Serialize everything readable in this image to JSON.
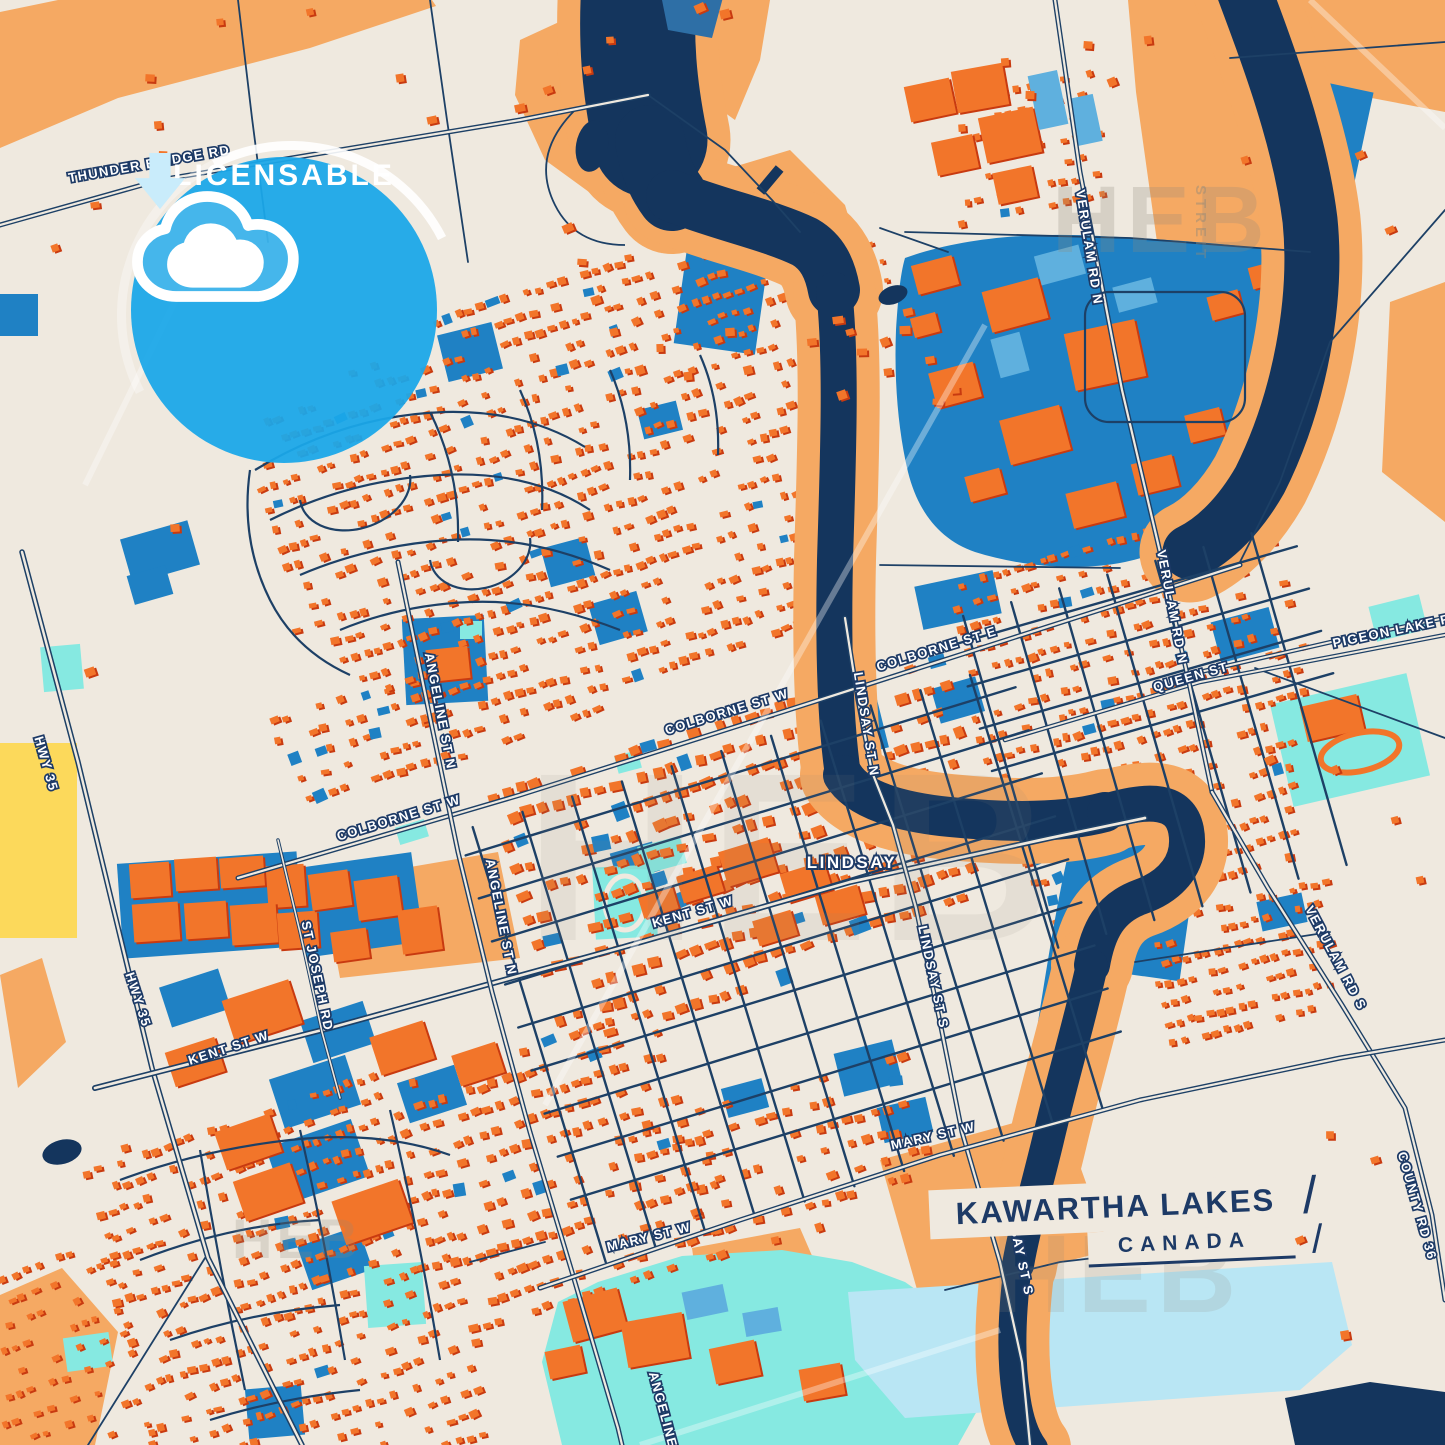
{
  "poster": {
    "region_label": "LINDSAY",
    "title": "KAWARTHA LAKES",
    "subtitle": "CANADA",
    "separator": "/",
    "badge": {
      "label": "LICENSABLE",
      "icon": "cloud-download-icon"
    },
    "watermark": {
      "brand": "HEB",
      "sub": "STREIT"
    },
    "street_labels": [
      {
        "id": "thunder",
        "text": "THUNDER BRIDGE RD"
      },
      {
        "id": "verulam-n-1",
        "text": "VERULAM RD N"
      },
      {
        "id": "verulam-n-2",
        "text": "VERULAM RD N"
      },
      {
        "id": "pigeon",
        "text": "PIGEON LAKE RD"
      },
      {
        "id": "queen",
        "text": "QUEEN ST"
      },
      {
        "id": "colborne-e",
        "text": "COLBORNE ST E"
      },
      {
        "id": "colborne-w-1",
        "text": "COLBORNE ST W"
      },
      {
        "id": "colborne-w-2",
        "text": "COLBORNE ST W"
      },
      {
        "id": "lindsay-n",
        "text": "LINDSAY ST N"
      },
      {
        "id": "kent-w-1",
        "text": "KENT ST W"
      },
      {
        "id": "kent-w-2",
        "text": "KENT ST W"
      },
      {
        "id": "lindsay-s-1",
        "text": "LINDSAY ST S"
      },
      {
        "id": "lindsay-s-2",
        "text": "LINDSAY ST S"
      },
      {
        "id": "angeline-n-1",
        "text": "ANGELINE ST N"
      },
      {
        "id": "angeline-n-2",
        "text": "ANGELINE ST N"
      },
      {
        "id": "angeline-s",
        "text": "ANGELINE ST S"
      },
      {
        "id": "st-joseph",
        "text": "ST JOSEPH RD"
      },
      {
        "id": "mary-w-1",
        "text": "MARY ST W"
      },
      {
        "id": "mary-w-2",
        "text": "MARY ST W"
      },
      {
        "id": "hwy35-1",
        "text": "HWY 35"
      },
      {
        "id": "hwy35-2",
        "text": "HWY 35"
      },
      {
        "id": "verulam-s",
        "text": "VERULAM RD S"
      },
      {
        "id": "county-36",
        "text": "COUNTY RD 36"
      }
    ],
    "colors": {
      "background": "#efe9df",
      "water": "#14355d",
      "roads": "#1d4066",
      "building": "#f2752a",
      "building_shadow": "#c83a10",
      "landuse": "#f5a963",
      "industrial": "#1f81c4",
      "industrial_light": "#5fb0de",
      "park": "#86e9e1",
      "lake": "#b9e6f4",
      "field": "#fcd95b",
      "badge_blue": "#1ba7e9",
      "title_navy": "#1d3a66"
    }
  }
}
